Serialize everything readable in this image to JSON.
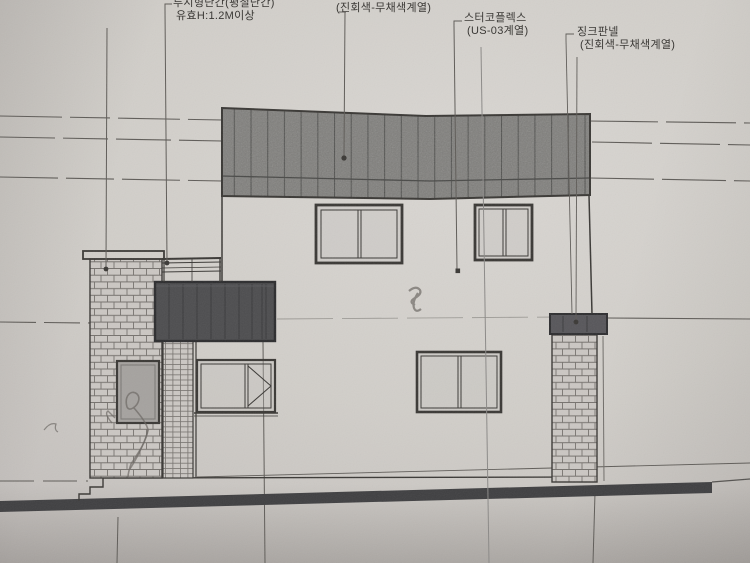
{
  "drawing": {
    "kind_note": "building side elevation drawing (photo of printed sheet)",
    "labels": {
      "roof_color_note": "(진회색-무채색계열)",
      "railing_name": "투시형난간(평철난간)",
      "railing_spec": "유효H:1.2M이상",
      "stucco_name": "스터코플렉스",
      "stucco_spec": "(US-03계열)",
      "zinc_name": "징크판넬",
      "zinc_spec": "(진회색-무채색계열)"
    }
  },
  "colors": {
    "paper_light": "#d9d6d2",
    "paper": "#d1cec9",
    "paper_dark": "#c3bfbc",
    "paper_edge": "#aeaaa7",
    "ink": "#3a3835",
    "line_faint": "#5e5b57",
    "text": "#3a3835",
    "roof": "#7c7b78",
    "roof_seam": "#4a4a48",
    "balcony": "#4d4d4f",
    "cap": "#57565a",
    "ground": "#3f3f41",
    "glass_dark": "#a5a29f",
    "brick_mortar": "#75716d",
    "brick_bg": "#cbc7c3",
    "pencil": "#6b6762"
  }
}
